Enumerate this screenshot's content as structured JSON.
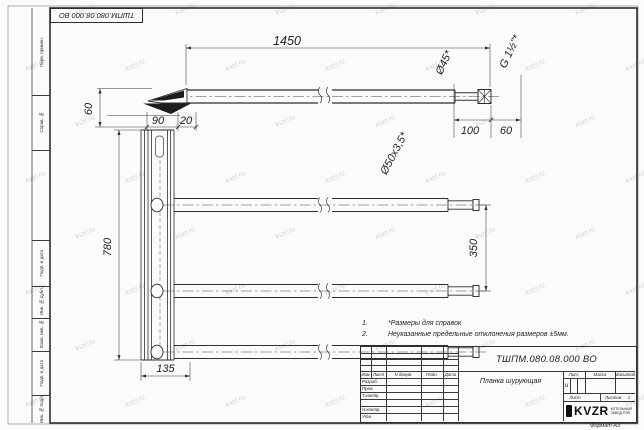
{
  "watermark": {
    "text": "kvzr.ru"
  },
  "page": {
    "format_label": "Формат А3"
  },
  "margin_labels": [
    "Перв. примен.",
    "Справ. №",
    "Подп. и дата",
    "Инв. № дубл.",
    "Взам. инв. №",
    "Подп. и дата",
    "Инв. № подл."
  ],
  "drawing": {
    "dims": {
      "total_length": "1450",
      "tip_offset": "60",
      "plate_w1": "90",
      "plate_w2": "20",
      "end_len": "100",
      "thread_len": "60",
      "dia_reduced": "Ø45*",
      "thread": "G 1½\"*",
      "tube": "Ø50х3,5*",
      "plate_height": "780",
      "tube_spacing": "350",
      "plate_depth": "135"
    }
  },
  "notes": {
    "n1_num": "1.",
    "n1": "*Размеры для справок",
    "n2_num": "2.",
    "n2": "Неуказанные предельные отклонения размеров ±5мм."
  },
  "title_block": {
    "designation": "ТШПМ.080.08.000 ВО",
    "name": "Планка шурующая",
    "litera": "и",
    "header_izm": "Изм.",
    "header_list": "Лист",
    "header_ndoc": "N докум.",
    "header_podp": "Подп.",
    "header_data": "Дата",
    "row_razrab": "Разраб.",
    "row_prov": "Пров.",
    "row_tkontr": "Т.контр.",
    "row_nkontr": "Н.контр.",
    "row_utv": "Утв.",
    "lit_label": "Лит.",
    "massa_label": "Масса",
    "masshtab_label": "Масштаб",
    "list_label": "Лист",
    "listov_label": "Листов",
    "listov_value": "1",
    "logo_text": "KVZR",
    "logo_sub1": "КОТЕЛЬНЫЙ",
    "logo_sub2": "ЗАВОД РЭП"
  }
}
